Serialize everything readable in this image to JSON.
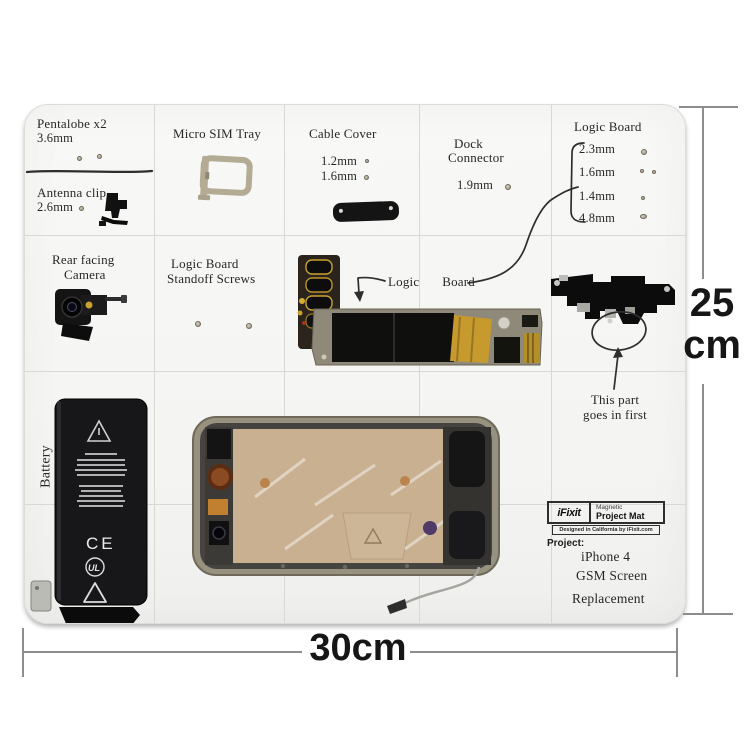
{
  "product": {
    "brand_logo": "iFixit",
    "brand_line1": "Magnetic",
    "brand_line2": "Project Mat",
    "brand_tagline": "Designed in California by iFixit.com",
    "project_label": "Project:",
    "project_name": [
      "iPhone 4",
      "GSM Screen",
      "Replacement"
    ]
  },
  "labels": {
    "pentalobe_title": "Pentalobe x2",
    "pentalobe_size": "3.6mm",
    "antenna_clip_title": "Antenna clip",
    "antenna_clip_size": "2.6mm",
    "sim_tray_title": "Micro SIM Tray",
    "cable_cover_title": "Cable Cover",
    "cable_cover_size1": "1.2mm",
    "cable_cover_size2": "1.6mm",
    "dock_title1": "Dock",
    "dock_title2": "Connector",
    "dock_size": "1.9mm",
    "logic_screws_title": "Logic Board",
    "logic_screw_sizes": [
      "2.3mm",
      "1.6mm",
      "1.4mm",
      "4.8mm"
    ],
    "camera_title1": "Rear facing",
    "camera_title2": "Camera",
    "standoff_title1": "Logic Board",
    "standoff_title2": "Standoff Screws",
    "logic_label1": "Logic",
    "logic_label2": "Board",
    "first_part_line1": "This part",
    "first_part_line2": "goes in first",
    "battery_label": "Battery"
  },
  "battery_markings": {
    "ce": "CE",
    "ul": "UL",
    "liion": "Li-ion"
  },
  "dimensions": {
    "height_value": "25",
    "height_unit": "cm",
    "width_value": "30cm"
  },
  "colors": {
    "mat": "#f5f5f3",
    "grid": "#d9d8d4",
    "ink": "#2e2e2e",
    "dimension_line": "#8d8d8d",
    "gold": "#c79a2e"
  }
}
